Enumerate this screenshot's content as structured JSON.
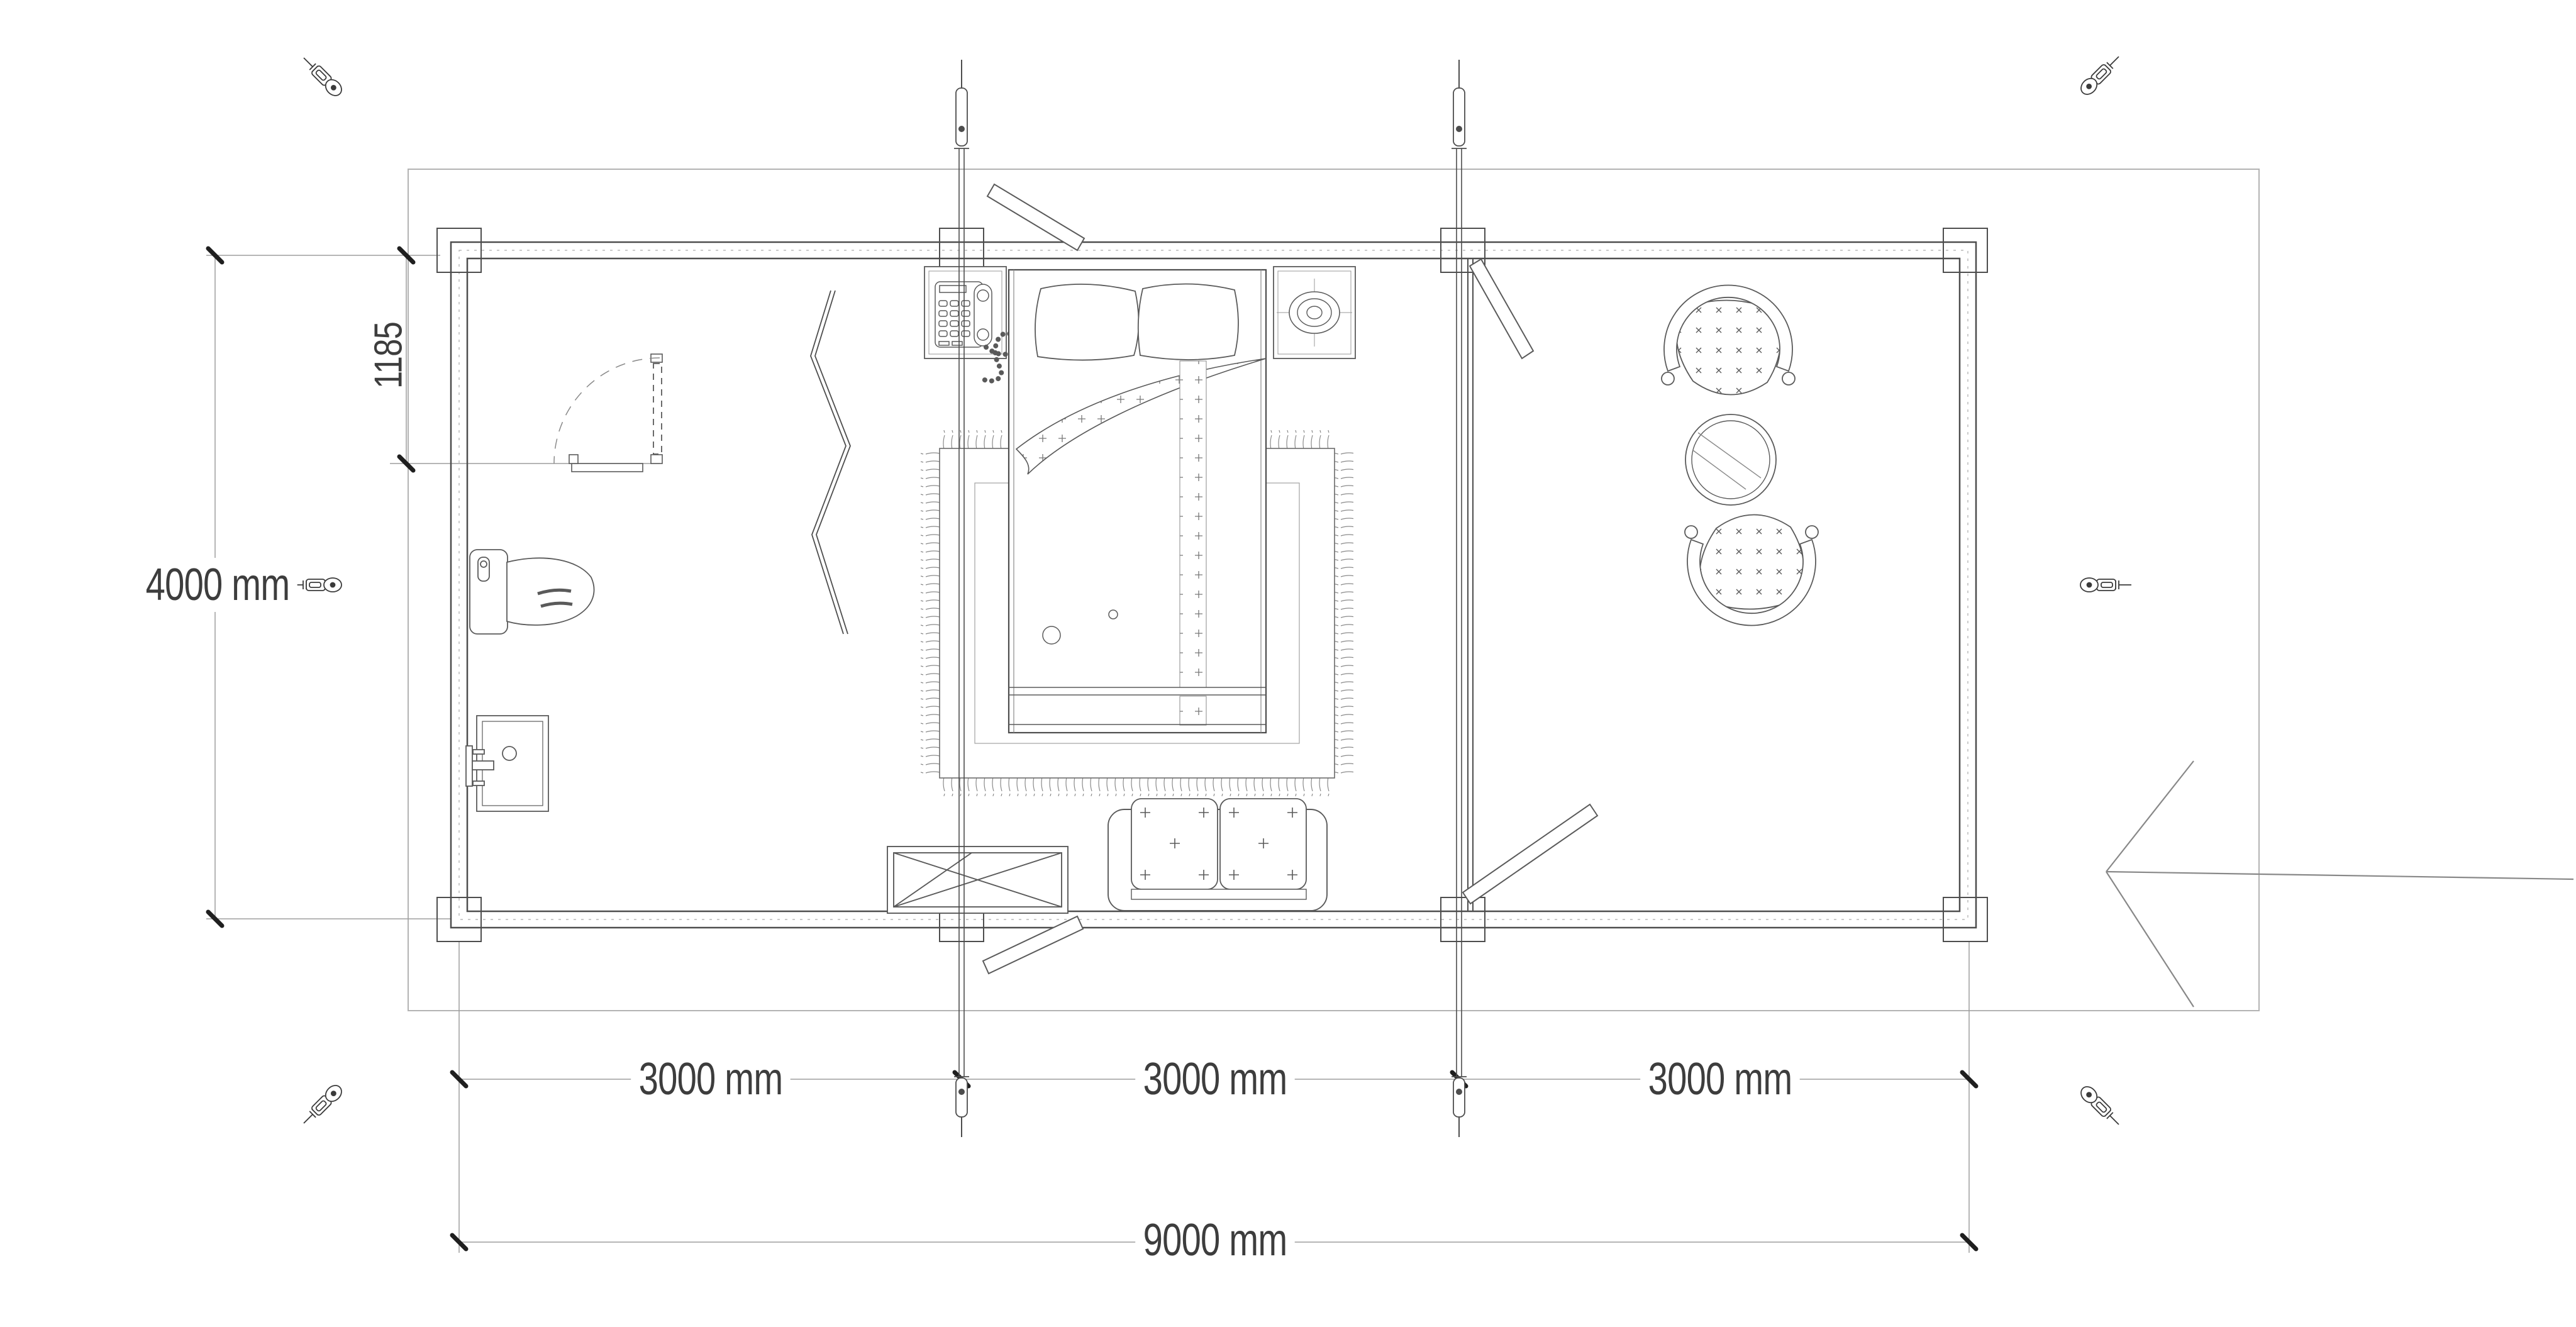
{
  "page": {
    "type": "architectural-floor-plan",
    "description": "Top view plan of a 9000 x 4000 mm cabin with bedroom, bathroom fixtures and lounge",
    "sheet_background": "#ffffff"
  },
  "dimensions": {
    "overall_width_label": "9000 mm",
    "bay_labels": [
      "3000 mm",
      "3000 mm",
      "3000 mm"
    ],
    "overall_depth_label": "4000 mm",
    "door_offset_label": "1185"
  },
  "colors": {
    "wall_line": "#4d4d4d",
    "furniture_line": "#5a5a5a",
    "boundary_line": "#b3b3b3",
    "dimension_line": "#9e9e9e",
    "dimension_tick": "#1f1f1f",
    "dimension_text": "#3d3d3d"
  },
  "icons": {
    "corner_fasteners": "turnbuckle-icon",
    "furniture": [
      "double-bed-icon",
      "pillow-icon",
      "rug-icon",
      "telephone-nightstand-icon",
      "lamp-nightstand-icon",
      "sofa-icon",
      "crossed-table-icon",
      "toilet-icon",
      "sink-icon",
      "armchair-icon",
      "round-glass-table-icon",
      "folding-screen-icon",
      "door-swing-icon",
      "entrance-arrow-icon",
      "tie-rod-icon"
    ]
  }
}
